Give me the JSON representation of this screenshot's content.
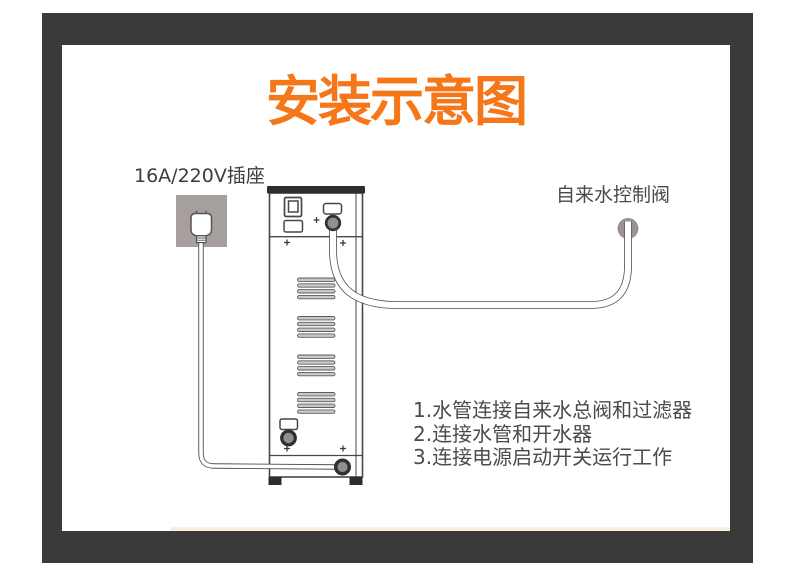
{
  "title": "安装示意图",
  "labels": {
    "socket": "16A/220V插座",
    "valve": "自来水控制阀"
  },
  "instructions": [
    "1.水管连接自来水总阀和过滤器",
    "2.连接水管和开水器",
    "3.连接电源启动开关运行工作"
  ],
  "colors": {
    "accent_orange": "#f6761a",
    "frame_dark": "#3a3a3b",
    "socket_gray": "#a79e9e",
    "valve_gray": "#9b9393",
    "outline_gray": "#474747",
    "text_gray": "#4b4b4b"
  }
}
